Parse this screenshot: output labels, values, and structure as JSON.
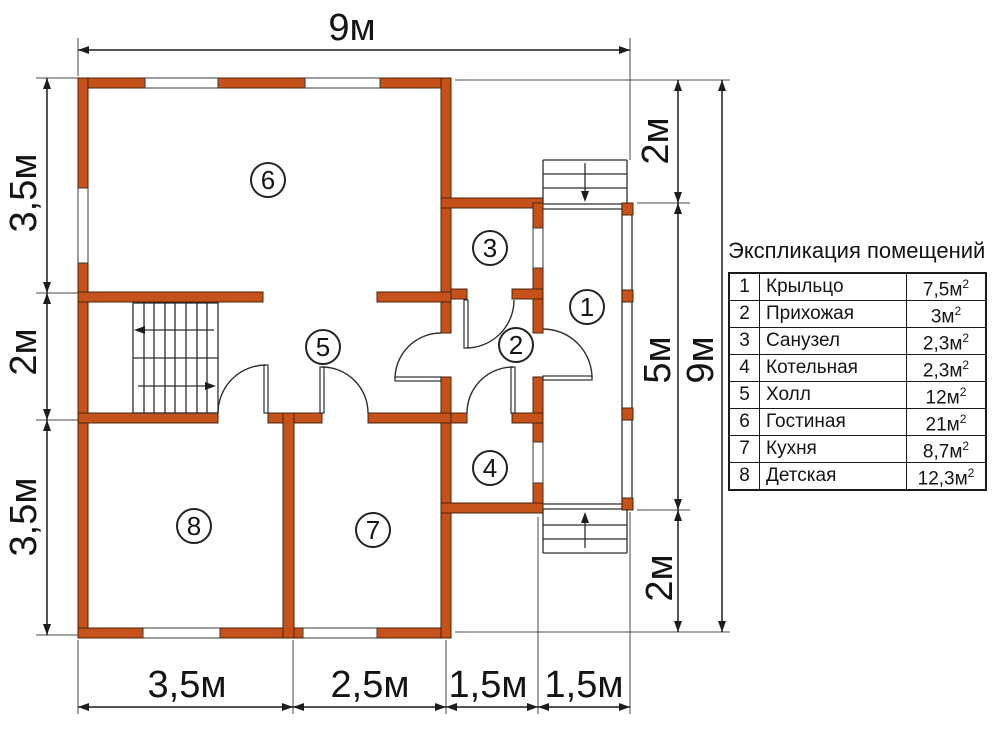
{
  "legend": {
    "title": "Экспликация помещений"
  },
  "rooms": [
    {
      "num": "1",
      "name": "Крыльцо",
      "area": "7,5м",
      "area_sup": "2"
    },
    {
      "num": "2",
      "name": "Прихожая",
      "area": "3м",
      "area_sup": "2"
    },
    {
      "num": "3",
      "name": "Санузел",
      "area": "2,3м",
      "area_sup": "2"
    },
    {
      "num": "4",
      "name": "Котельная",
      "area": "2,3м",
      "area_sup": "2"
    },
    {
      "num": "5",
      "name": "Холл",
      "area": "12м",
      "area_sup": "2"
    },
    {
      "num": "6",
      "name": "Гостиная",
      "area": "21м",
      "area_sup": "2"
    },
    {
      "num": "7",
      "name": "Кухня",
      "area": "8,7м",
      "area_sup": "2"
    },
    {
      "num": "8",
      "name": "Детская",
      "area": "12,3м",
      "area_sup": "2"
    }
  ],
  "dims": {
    "width_total": "9м",
    "left_top": "3,5м",
    "left_mid": "2м",
    "left_bottom": "3,5м",
    "right_top": "2м",
    "right_mid": "5м",
    "right_bottom": "2м",
    "right_total": "9м",
    "bottom_1": "3,5м",
    "bottom_2": "2,5м",
    "bottom_3": "1,5м",
    "bottom_4": "1,5м"
  },
  "colors": {
    "wall": "#c5521b",
    "walledge": "#4a2408",
    "line": "#1c1c1c",
    "ink": "#141414",
    "bg": "#ffffff"
  }
}
